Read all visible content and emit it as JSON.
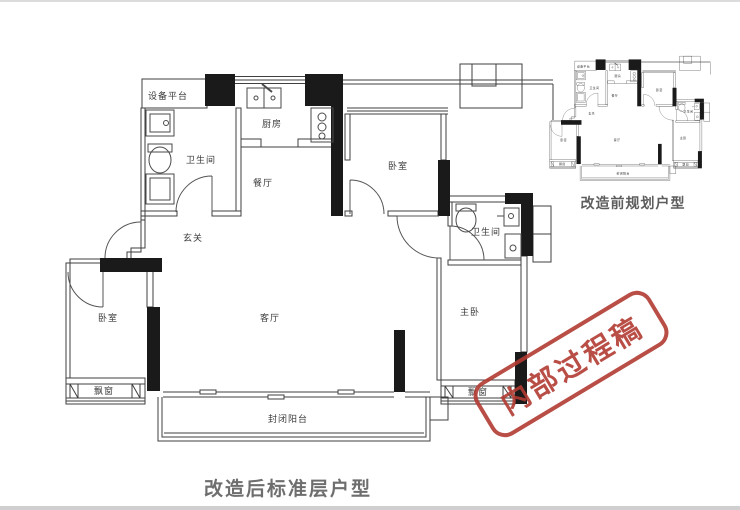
{
  "page": {
    "caption_main": "改造后标准层户型",
    "caption_mini": "改造前规划户型"
  },
  "stamp": {
    "text": "内部过程稿",
    "color": "#b23b32"
  },
  "rooms": {
    "equipment_platform": "设备平台",
    "bathroom_top_left": "卫生间",
    "kitchen": "厨房",
    "dining": "餐厅",
    "entry": "玄关",
    "living": "客厅",
    "bedroom_top": "卧室",
    "bathroom_right": "卫生间",
    "master_bedroom": "主卧",
    "bedroom_left": "卧室",
    "bay_window_left": "飘窗",
    "bay_window_right": "飘窗",
    "balcony": "封闭阳台"
  },
  "colors": {
    "wall_fill": "#1a1a1a",
    "wall_line": "#3f3f3f",
    "caption": "#6e6e6e",
    "stamp_red": "#b23b32",
    "background": "#ffffff"
  }
}
